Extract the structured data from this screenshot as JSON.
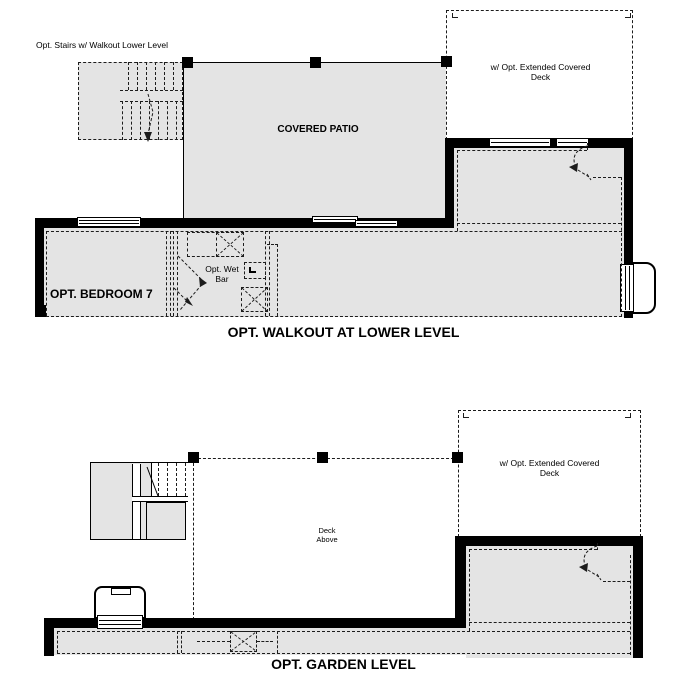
{
  "colors": {
    "room_fill": "#e4e4e4",
    "wall": "#000000",
    "dash_line": "#1c1c1c",
    "background": "#ffffff"
  },
  "plans": {
    "walkout": {
      "title": "OPT. WALKOUT AT LOWER LEVEL",
      "labels": {
        "stairs": "Opt. Stairs w/ Walkout Lower Level",
        "patio": "COVERED PATIO",
        "extended_deck": "w/ Opt. Extended Covered Deck",
        "bedroom": "OPT. BEDROOM 7",
        "wet_bar": "Opt. Wet Bar"
      }
    },
    "garden": {
      "title": "OPT. GARDEN LEVEL",
      "labels": {
        "extended_deck": "w/ Opt. Extended Covered Deck",
        "deck_above": "Deck Above"
      }
    }
  }
}
